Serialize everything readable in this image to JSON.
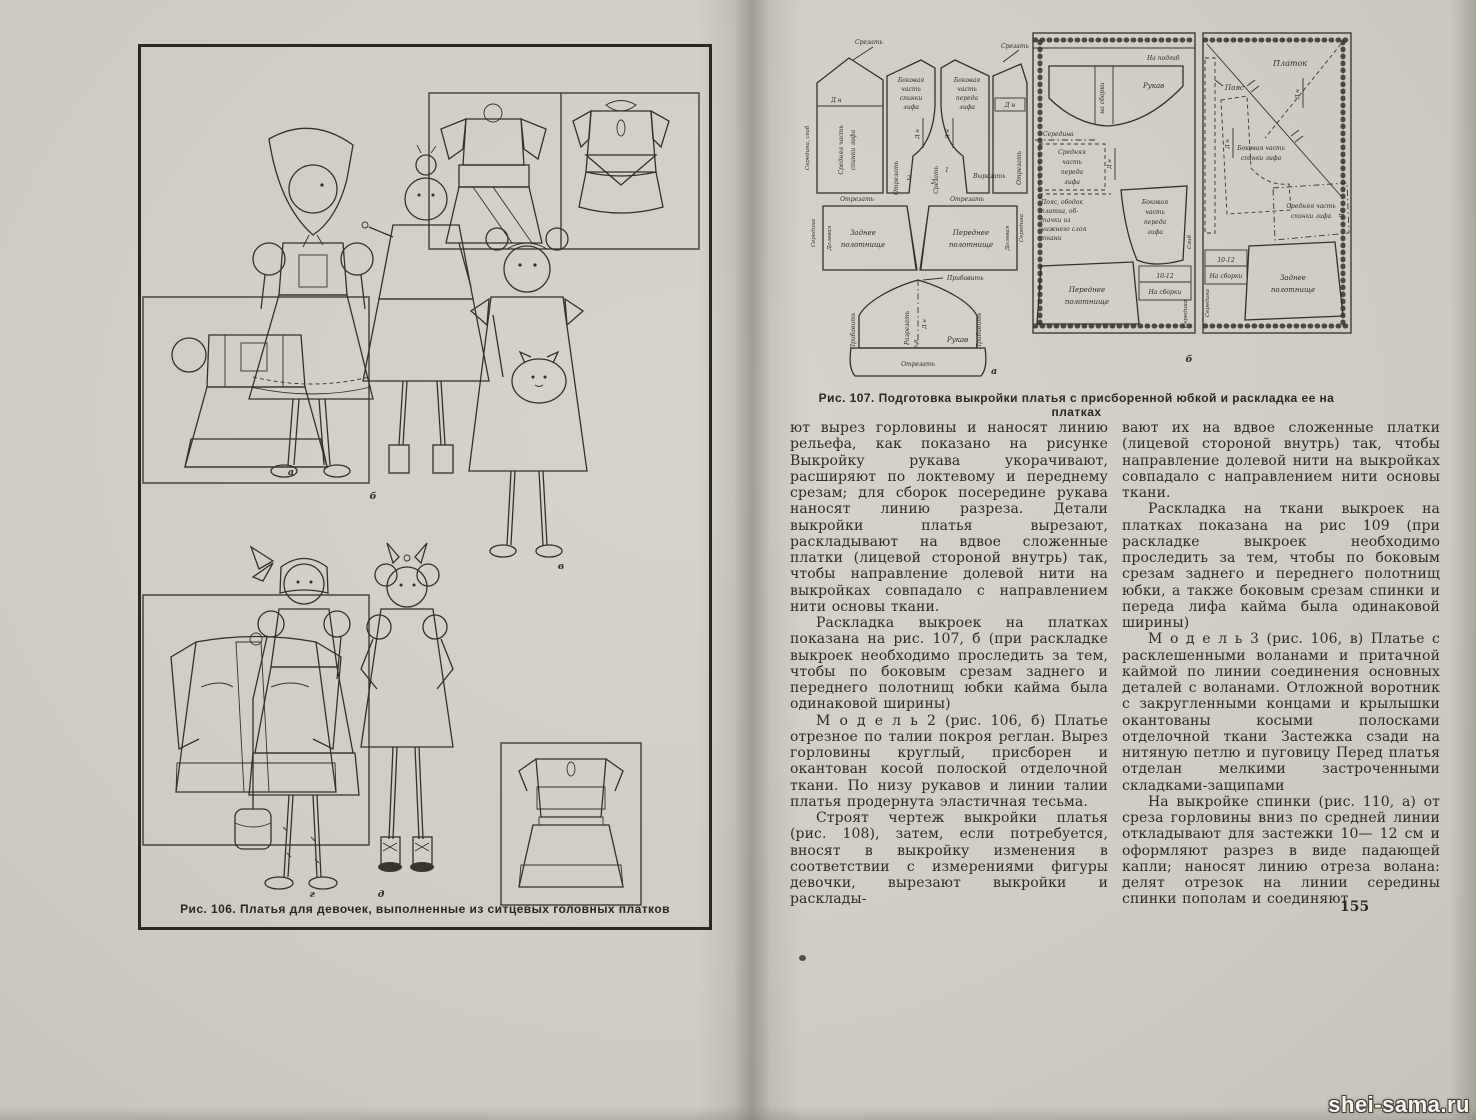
{
  "paper_color": "#d0cdc5",
  "ink_color": "#2e2a24",
  "watermark": "shei-sama.ru",
  "page_number": "155",
  "left_page": {
    "caption": "Рис. 106. Платья для девочек, выполненные из ситцевых головных платков",
    "labels": {
      "a": "а",
      "b": "б",
      "v": "в",
      "g": "г",
      "d": "д"
    }
  },
  "right_page": {
    "diagram": {
      "caption": "Рис. 107. Подготовка выкройки платья с присборенной юбкой и раскладка ее на платках",
      "part_a": "а",
      "part_b": "б",
      "labels": {
        "srezat": "Срезать",
        "otrezat": "Отрезать",
        "vyrezat": "Вырезать",
        "razrezat": "Разрезать",
        "pribavit": "Прибавить",
        "dn": "Д н",
        "n68": "6-8",
        "seredina_sgib": "Середина, сгиб",
        "seredina": "Середина",
        "sgib": "Сгиб",
        "dolevaya": "Долевая",
        "rukav": "Рукав",
        "na_podgib": "На подгиб",
        "na_sborki": "На сборки",
        "na_sborki_lc": "на сборки",
        "poyas": "Пояс",
        "platok": "Платок",
        "ten12": "10-12",
        "num1": "1",
        "num2": "2"
      },
      "multiline": {
        "srednyaya_spinki": [
          "Средняя часть",
          "спинки лифа"
        ],
        "bokovaya_spinki4": [
          "Боковая",
          "часть",
          "спинки",
          "лифа"
        ],
        "bokovaya_pereda4": [
          "Боковая",
          "часть",
          "переда",
          "лифа"
        ],
        "srednyaya_pereda4": [
          "Средняя",
          "часть",
          "переда",
          "лифа"
        ],
        "bokovaya_spinki2": [
          "Боковая часть",
          "спинки лифа"
        ],
        "zadnee": [
          "Заднее",
          "полотнище"
        ],
        "perednee": [
          "Переднее",
          "полотнище"
        ],
        "poyas_obodok": [
          "Пояс, ободок",
          "платка, об-",
          "тачки из",
          "нижнего слоя",
          "ткани"
        ]
      }
    },
    "columns": {
      "left": {
        "paragraphs": [
          "ют вырез горловины и наносят линию рельефа, как показано на рисунке Выкройку рукава укорачивают, расширяют по локтевому и переднему срезам; для сборок посередине рукава наносят линию разреза. Детали выкройки платья вырезают, раскладывают на вдвое сложенные платки (лицевой стороной внутрь) так, чтобы направление долевой нити на выкройках совпадало с направлением нити основы ткани.",
          "Раскладка выкроек на платках показана на рис. 107, б (при раскладке выкроек необходимо проследить за тем, чтобы по боковым срезам заднего и переднего полотнищ юбки кайма была одинаковой ширины)",
          "М о д е л ь  2 (рис. 106, б) Платье отрезное по талии покроя реглан. Вырез горловины круглый, присборен и окантован косой полоской отделочной ткани. По низу рукавов и линии талии платья продернута эластичная тесьма.",
          "Строят чертеж выкройки платья (рис. 108), затем, если потребуется, вносят в выкройку изменения в соответствии с измерениями фигуры девочки, вырезают выкройки и расклады-"
        ]
      },
      "right": {
        "paragraphs": [
          "вают их на вдвое сложенные платки (лицевой стороной внутрь) так, чтобы направление долевой нити на выкройках совпадало с направлением нити основы ткани.",
          "Раскладка на ткани выкроек на платках показана на рис 109 (при раскладке выкроек необходимо проследить за тем, чтобы по боковым срезам заднего и переднего полотнищ юбки, а также боковым срезам спинки и переда лифа кайма была одинаковой ширины)",
          "М о д е л ь  3 (рис. 106, в) Платье с расклешенными воланами и притачной каймой по линии соединения основных деталей с воланами. Отложной воротник с закругленными концами и крылышки окантованы косыми полосками отделочной ткани Застежка сзади на нитяную петлю и пуговицу Перед платья отделан мелкими застроченными складками-защипами",
          "На выкройке спинки (рис. 110, а) от среза горловины вниз по средней линии откладывают для застежки 10— 12 см и оформляют разрез в виде падающей капли; наносят линию отреза волана: делят отрезок на линии середины спинки пополам и соединяют"
        ]
      }
    }
  }
}
